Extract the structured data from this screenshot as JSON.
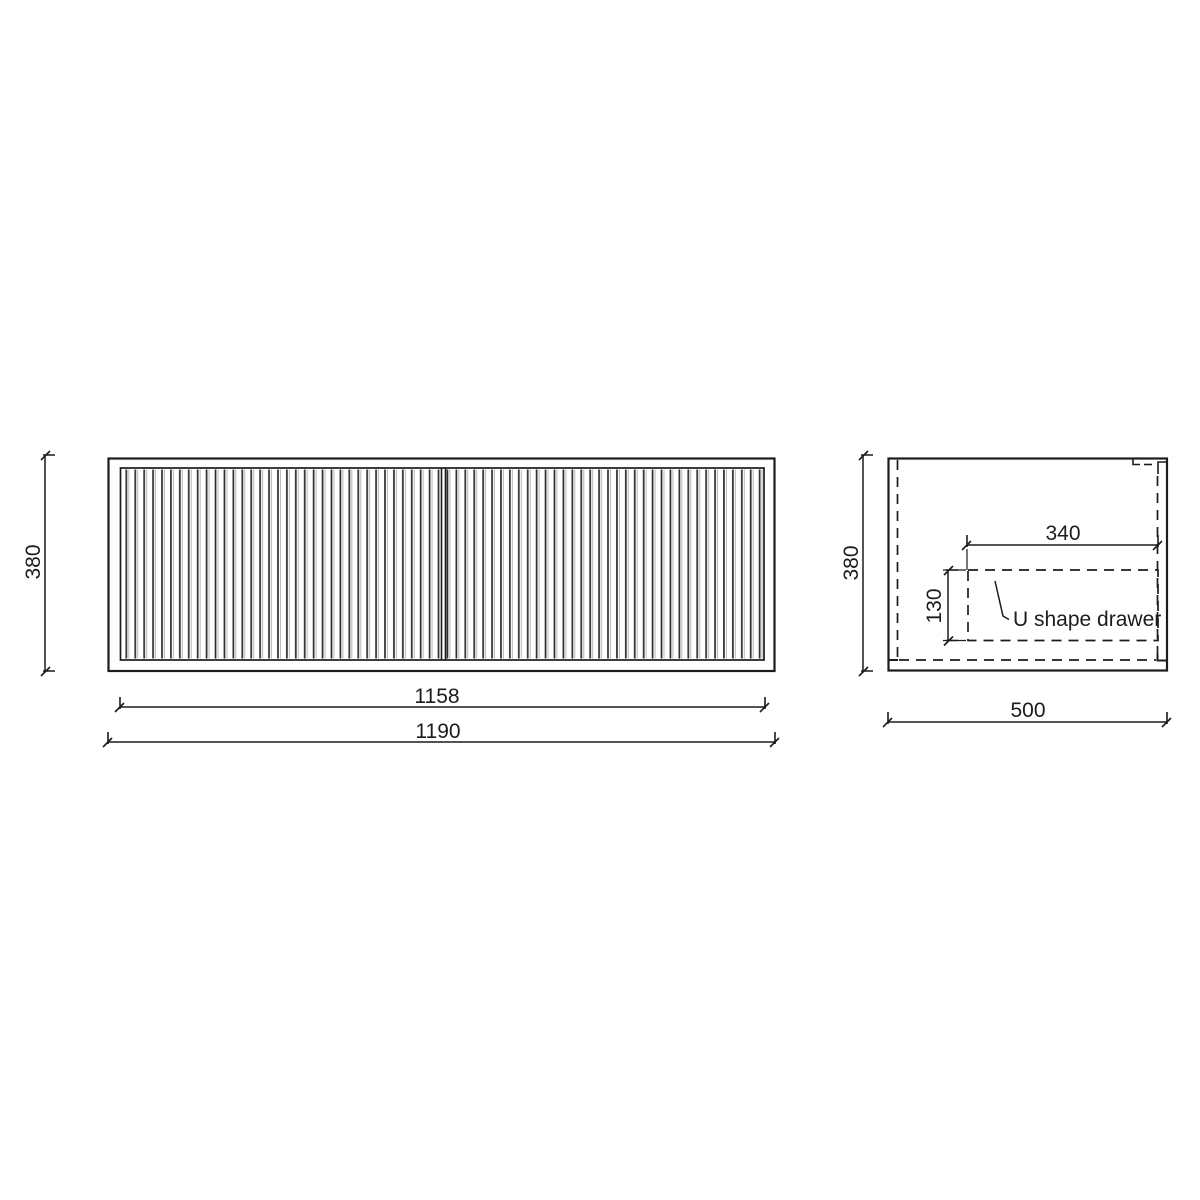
{
  "page": {
    "background": "#ffffff"
  },
  "drawing": {
    "line_color": "#1c1c1c",
    "flute_light_color": "#b8b8b8",
    "front_view": {
      "overall_width": "1190",
      "door_span_width": "1158",
      "height": "380"
    },
    "side_view": {
      "depth": "500",
      "height": "380",
      "drawer_width": "340",
      "drawer_depth": "130",
      "drawer_label": "U shape drawer"
    }
  }
}
